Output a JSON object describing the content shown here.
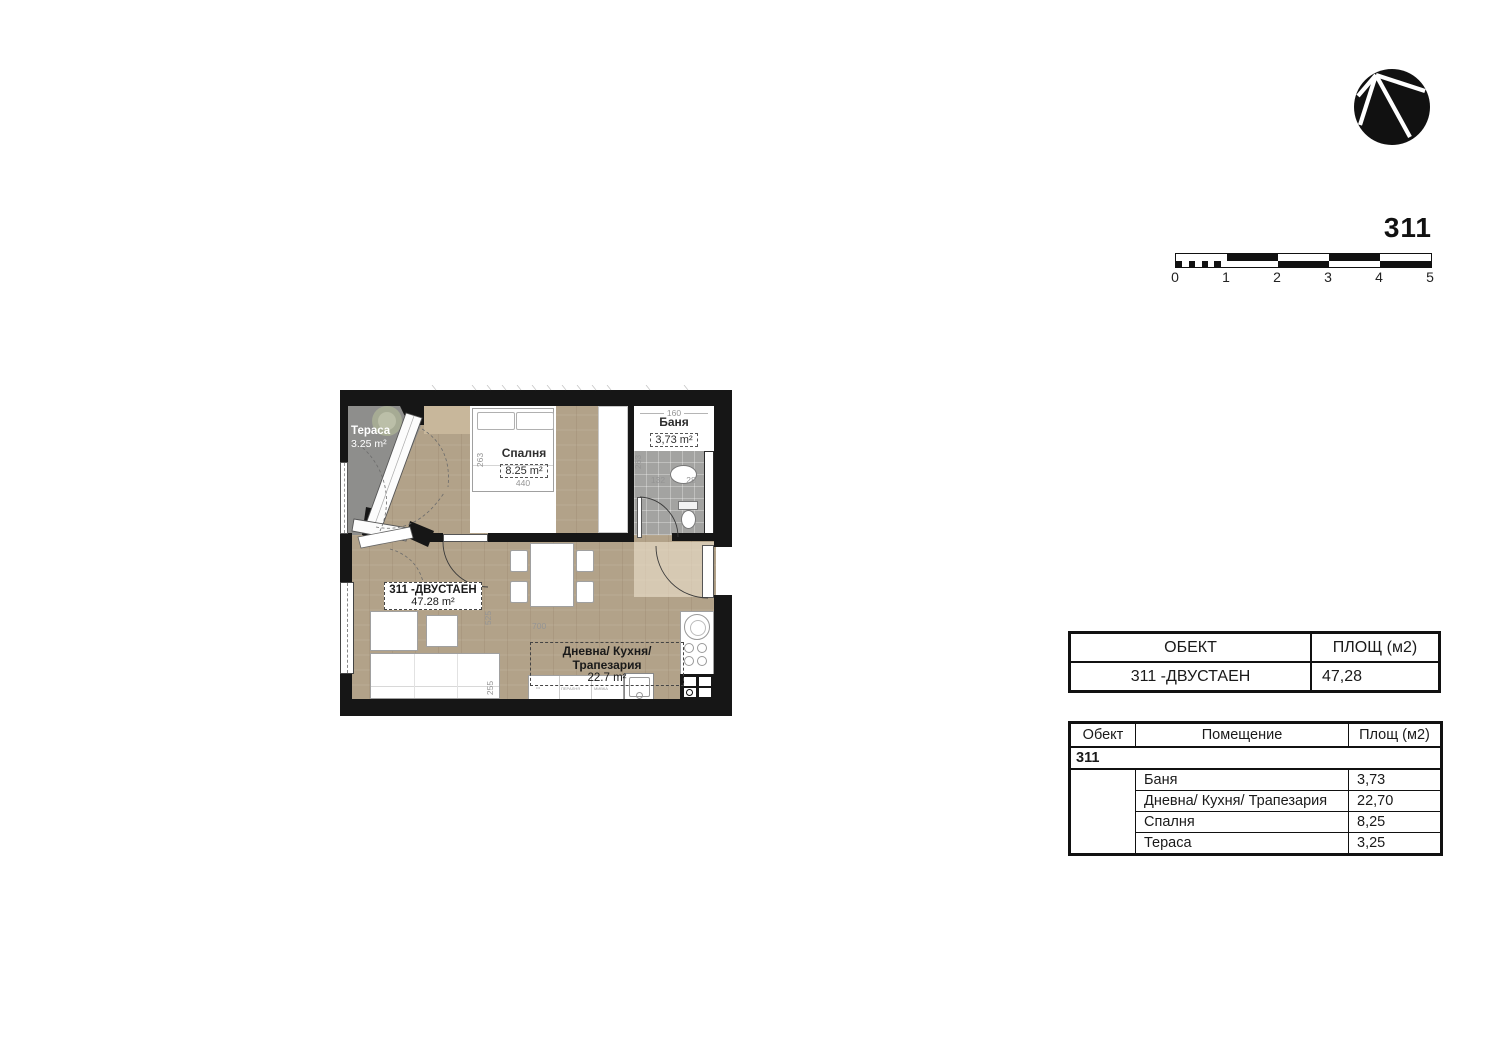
{
  "header": {
    "unit_number": "311"
  },
  "logo": {
    "icon": "arco-circle-logo"
  },
  "scale_bar": {
    "tick_labels": [
      "0",
      "1",
      "2",
      "3",
      "4",
      "5"
    ]
  },
  "floor_plan": {
    "unit_label": {
      "title": "311 -ДВУСТАЕН",
      "area": "47.28 m²"
    },
    "terrace": {
      "name": "Тераса",
      "area": "3.25 m²"
    },
    "bedroom": {
      "name": "Спалня",
      "area": "8.25 m²",
      "width": "440",
      "height": "263"
    },
    "bathroom": {
      "name": "Баня",
      "area": "3,73 m²",
      "width": "160",
      "height": "263",
      "dim_a": "132",
      "dim_b": "28"
    },
    "living": {
      "name": "Дневна/ Кухня/ Трапезария",
      "area": "22.7 m²",
      "width": "700",
      "height": "525",
      "dim_bottom": "255"
    },
    "kitchen": {
      "counter_dots": "•••",
      "appliance_1": "ПЕРАЛНЯ",
      "appliance_2": "МИВКА"
    }
  },
  "summary_table": {
    "col_object": "ОБЕКТ",
    "col_area": "ПЛОЩ (м2)",
    "row": {
      "object": "311 -ДВУСТАЕН",
      "area": "47,28"
    }
  },
  "rooms_table": {
    "col_object": "Обект",
    "col_room": "Помещение",
    "col_area": "Площ (м2)",
    "group": "311",
    "rows": [
      {
        "room": "Баня",
        "area": "3,73"
      },
      {
        "room": "Дневна/ Кухня/ Трапезария",
        "area": "22,70"
      },
      {
        "room": "Спалня",
        "area": "8,25"
      },
      {
        "room": "Тераса",
        "area": "3,25"
      }
    ]
  }
}
